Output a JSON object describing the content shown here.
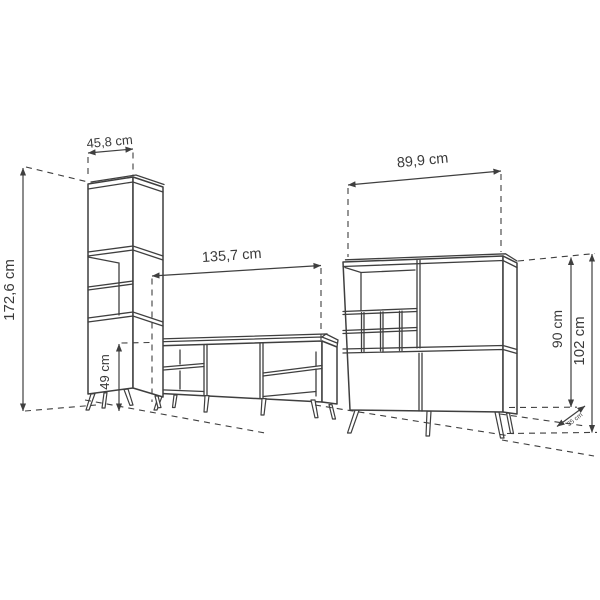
{
  "diagram": {
    "name": "furniture-set-dimension-drawing",
    "colors": {
      "line": "#3f3f3f",
      "background": "#ffffff"
    },
    "pieces": {
      "tall_cabinet": {
        "name": "tall cabinet"
      },
      "tv_stand": {
        "name": "tv stand"
      },
      "bar_cabinet": {
        "name": "bar cabinet"
      }
    }
  },
  "dimensions": {
    "tall_cabinet_width": "45,8 cm",
    "tall_cabinet_height": "172,6 cm",
    "tv_stand_width": "135,7 cm",
    "tv_stand_height": "49 cm",
    "bar_cabinet_width": "89,9 cm",
    "bar_cabinet_body_height": "90 cm",
    "bar_cabinet_total_height": "102 cm",
    "bar_cabinet_depth": "35 cm"
  }
}
